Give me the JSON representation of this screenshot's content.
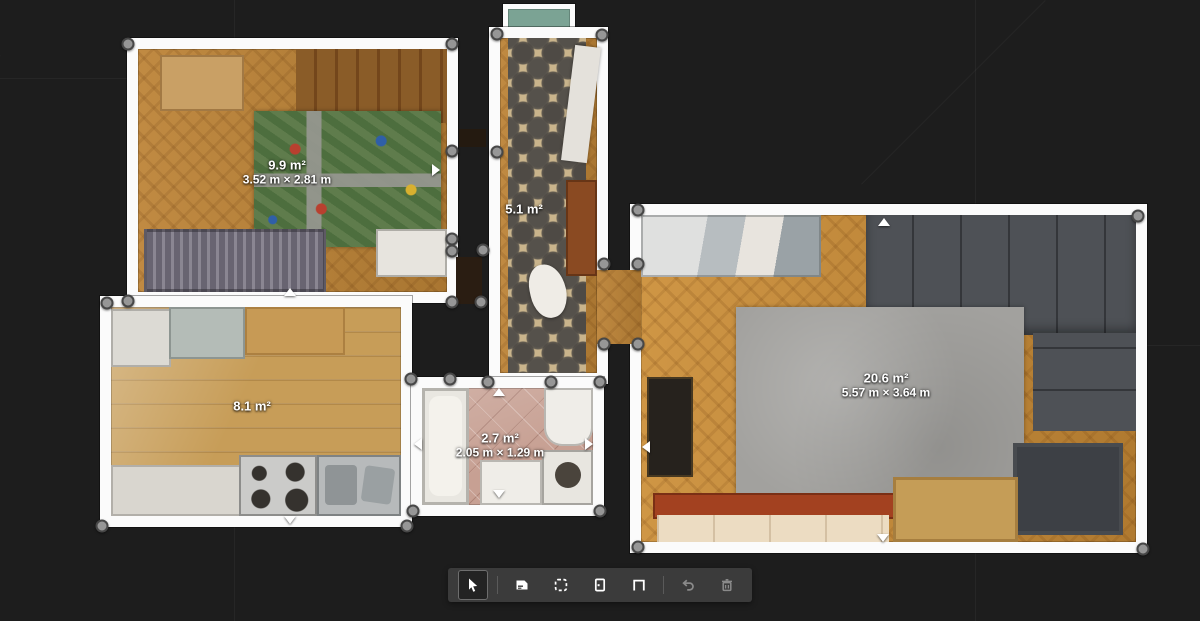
{
  "app": {
    "view": "floor-plan-editor",
    "colors": {
      "background": "#1d1d1d",
      "wall": "#fbfbfb",
      "handle_fill": "#969696",
      "handle_ring": "#474747",
      "toolbar_bg": "#3b3b3b",
      "label_text": "#ffffff"
    }
  },
  "rooms": {
    "kids": {
      "area": "9.9 m²",
      "dimensions": "3.52 m × 2.81 m"
    },
    "hallway": {
      "area": "5.1 m²",
      "dimensions": ""
    },
    "kitchen": {
      "area": "8.1 m²",
      "dimensions": ""
    },
    "bathroom": {
      "area": "2.7 m²",
      "dimensions": "2.05 m × 1.29 m"
    },
    "living": {
      "area": "20.6 m²",
      "dimensions": "5.57 m × 3.64 m"
    }
  },
  "toolbar": {
    "tools": [
      {
        "name": "select-tool",
        "icon": "cursor-icon",
        "active": true,
        "disabled": false
      },
      {
        "name": "add-room-tool",
        "icon": "add-room-icon",
        "active": false,
        "disabled": false
      },
      {
        "name": "draw-region-tool",
        "icon": "dashed-region-icon",
        "active": false,
        "disabled": false
      },
      {
        "name": "add-door-tool",
        "icon": "door-icon",
        "active": false,
        "disabled": false
      },
      {
        "name": "add-opening-tool",
        "icon": "opening-icon",
        "active": false,
        "disabled": false
      },
      {
        "name": "undo-button",
        "icon": "undo-icon",
        "active": false,
        "disabled": true
      },
      {
        "name": "delete-button",
        "icon": "trash-icon",
        "active": false,
        "disabled": true
      }
    ]
  }
}
